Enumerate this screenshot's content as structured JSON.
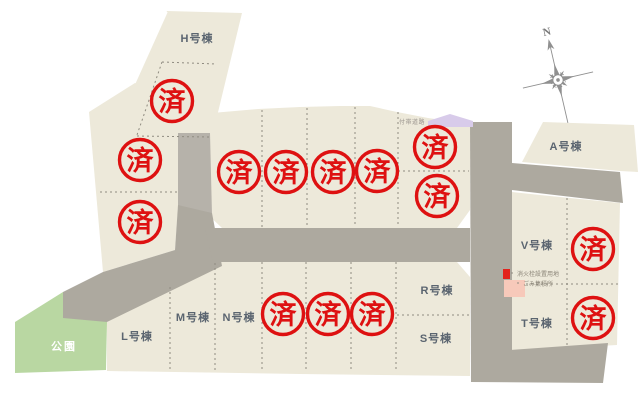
{
  "stamp_label": "済",
  "compass_label": "N",
  "park_label": "公園",
  "annotation_road": "付帯道路",
  "legend": {
    "item1": "消火栓設置用地",
    "item2": "ごみ集積所"
  },
  "lots": {
    "h": "H号棟",
    "a": "A号棟",
    "v": "V号棟",
    "t": "T号棟",
    "r": "R号棟",
    "s": "S号棟",
    "m": "M号棟",
    "n": "N号棟",
    "l": "L号棟"
  },
  "stamps": [
    {
      "x": 172,
      "y": 101
    },
    {
      "x": 140,
      "y": 160
    },
    {
      "x": 140,
      "y": 222
    },
    {
      "x": 239,
      "y": 172
    },
    {
      "x": 286,
      "y": 172
    },
    {
      "x": 333,
      "y": 172
    },
    {
      "x": 377,
      "y": 171
    },
    {
      "x": 435,
      "y": 147
    },
    {
      "x": 437,
      "y": 196
    },
    {
      "x": 283,
      "y": 314
    },
    {
      "x": 328,
      "y": 314
    },
    {
      "x": 372,
      "y": 314
    },
    {
      "x": 593,
      "y": 249
    },
    {
      "x": 593,
      "y": 318
    }
  ],
  "colors": {
    "lot": "#EDE9DA",
    "road": "#ADA99F",
    "road_dark": "#B6B2AA",
    "park": "#B9D7A2",
    "stamp_red": "#DE1111",
    "label": "#5B6570",
    "walkway": "#D8CBEA",
    "legend_red": "#E3221C",
    "legend_pink": "#F7C9BA",
    "dash": "#8F8B80",
    "compass": "#909090"
  }
}
